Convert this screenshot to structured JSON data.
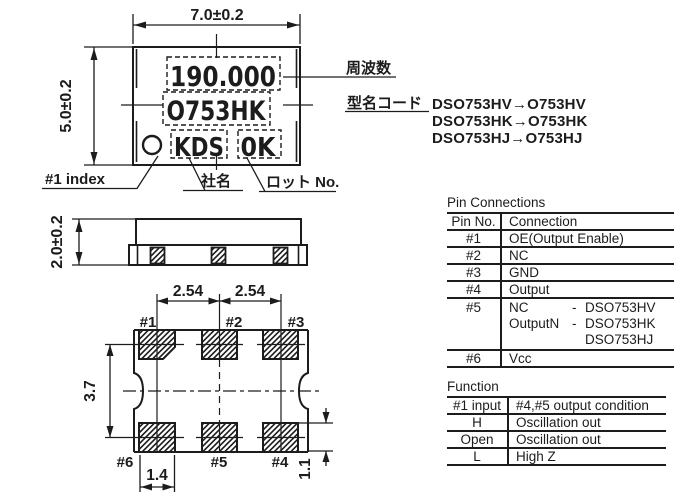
{
  "top_view": {
    "dim_width": "7.0±0.2",
    "dim_height": "5.0±0.2",
    "marking": {
      "frequency": "190.000",
      "model_code": "O753HK",
      "company": "KDS",
      "lot": "0K"
    },
    "callouts": {
      "index": "#1 index",
      "company": "社名",
      "lot": "ロット No.",
      "frequency": "周波数",
      "model_code": "型名コード"
    },
    "model_code_notes": [
      "DSO753HV→O753HV",
      "DSO753HK→O753HK",
      "DSO753HJ→O753HJ"
    ]
  },
  "side_view": {
    "dim_height": "2.0±0.2"
  },
  "bottom_view": {
    "dim_pitch_left": "2.54",
    "dim_pitch_right": "2.54",
    "dim_row_pitch": "3.7",
    "dim_pad_width": "1.4",
    "dim_pad_height": "1.1",
    "pads": {
      "p1": "#1",
      "p2": "#2",
      "p3": "#3",
      "p4": "#4",
      "p5": "#5",
      "p6": "#6"
    }
  },
  "pin_connections": {
    "title": "Pin Connections",
    "headers": {
      "pin": "Pin No.",
      "connection": "Connection"
    },
    "rows": [
      {
        "pin": "#1",
        "connection": "OE(Output Enable)"
      },
      {
        "pin": "#2",
        "connection": "NC"
      },
      {
        "pin": "#3",
        "connection": "GND"
      },
      {
        "pin": "#4",
        "connection": "Output"
      },
      {
        "pin": "#5",
        "lines": [
          {
            "signal": "NC",
            "sep": "-",
            "model": "DSO753HV"
          },
          {
            "signal": "OutputN",
            "sep": "-",
            "model": "DSO753HK"
          },
          {
            "signal": "",
            "sep": "",
            "model": "DSO753HJ"
          }
        ]
      },
      {
        "pin": "#6",
        "connection": "Vcc"
      }
    ]
  },
  "function_table": {
    "title": "Function",
    "headers": {
      "input": "#1 input",
      "output": "#4,#5 output condition"
    },
    "rows": [
      {
        "input": "H",
        "output": "Oscillation out"
      },
      {
        "input": "Open",
        "output": "Oscillation out"
      },
      {
        "input": "L",
        "output": "High Z"
      }
    ]
  }
}
